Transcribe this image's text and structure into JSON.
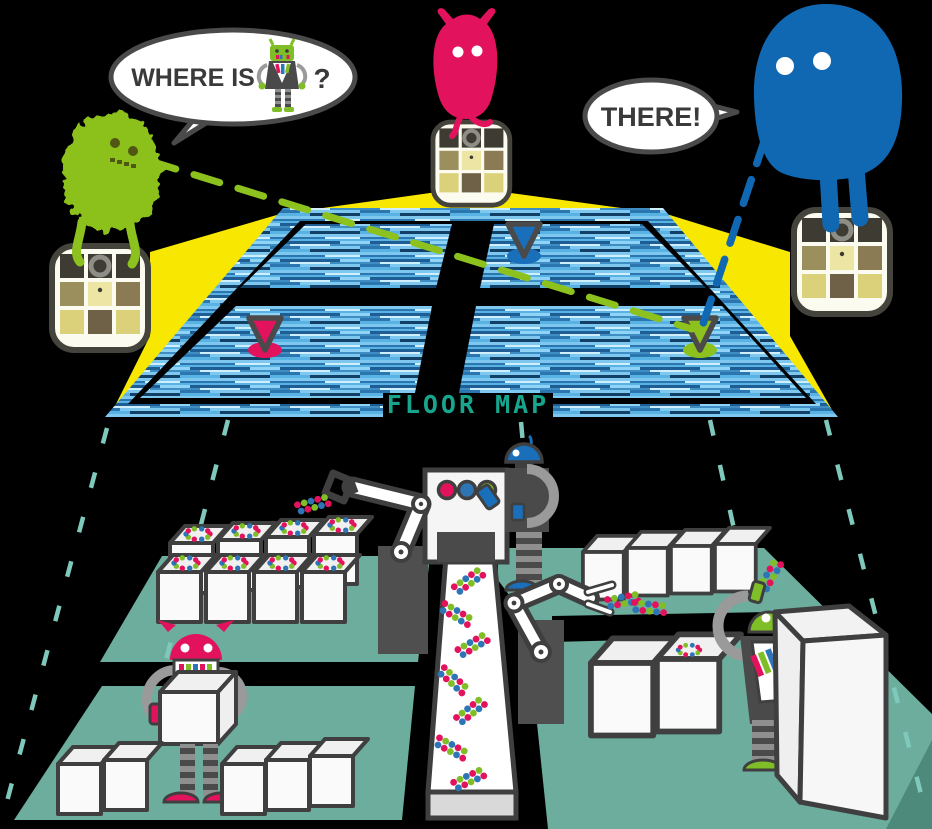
{
  "illustration": {
    "question_bubble": {
      "prefix": "WHERE IS",
      "suffix": "?"
    },
    "answer_bubble": {
      "text": "THERE!"
    },
    "floor_map_label": "FLOOR MAP",
    "monsters": [
      {
        "name": "green-monster",
        "color": "#8CC11E"
      },
      {
        "name": "pink-monster",
        "color": "#E3125C"
      },
      {
        "name": "blue-monster",
        "color": "#1168B2"
      }
    ],
    "map_pins": [
      {
        "name": "pink-pin",
        "color": "#E3125C"
      },
      {
        "name": "blue-pin",
        "color": "#1A6FBA"
      },
      {
        "name": "green-pin",
        "color": "#8CC11E"
      }
    ],
    "colors": {
      "background": "#000000",
      "beam_yellow": "#F8E700",
      "floor_teal": "#6CAD9D",
      "floor_teal_dark": "#4E8A7B",
      "guide_dash_teal": "#7EC9BC",
      "map_label_teal": "#17A58E",
      "map_panel_blue": "#4FA6D8",
      "outline_dark": "#3F3F3F"
    }
  }
}
